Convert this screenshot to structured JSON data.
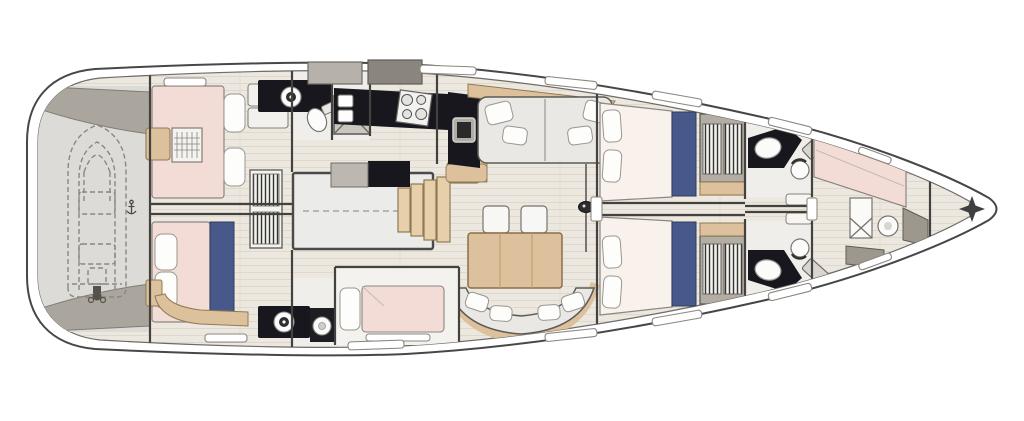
{
  "title": "Sailing yacht interior deck plan — top-down layout drawing, bow to the right",
  "canvas": {
    "width": 1024,
    "height": 421
  },
  "palette": {
    "outline": "#45423f",
    "floor_wood": "#ece8e0",
    "plank_line": "#d9d3c7",
    "deck_gray": "#aba69d",
    "garage_gray": "#dcdbd7",
    "bed_pink": "#f3dcd6",
    "pillow_white": "#fdfdfc",
    "accent_blue": "#47598b",
    "counter_dark": "#17171d",
    "furniture_gray": "#e9e8e4",
    "wood_tan": "#dcc19c",
    "steps_tan": "#e7d0a9",
    "wardrobe_gray": "#b3ada4",
    "white": "#ffffff"
  },
  "features": {
    "hull": {
      "label": "Hull outline"
    },
    "deck": {
      "label": "Side deck"
    },
    "cockpit": {
      "label": "Cockpit hatch boxes"
    },
    "garage": {
      "label": "Transom tender garage"
    },
    "dinghy": {
      "label": "Stowed dinghy (dashed outline)"
    },
    "motor": {
      "label": "Outboard motor"
    },
    "stern_marker": {
      "label": "Transom centerline cleat"
    },
    "aft_cabin_port": {
      "label": "Aft cabin (port) — double berth"
    },
    "aft_cabin_stbd": {
      "label": "Aft cabin (starboard) — double berth with blue runner"
    },
    "bookshelf": {
      "label": "Centerline bookshelf"
    },
    "aft_head_port": {
      "label": "Aft head (port) — sink and toilet"
    },
    "aft_head_stbd": {
      "label": "Aft head (starboard) — sink and toilet"
    },
    "shower": {
      "label": "Shower stall"
    },
    "engine": {
      "label": "Engine compartment under cockpit"
    },
    "steps": {
      "label": "Companionway steps"
    },
    "nav_seat": {
      "label": "Chart seat"
    },
    "galley": {
      "label": "Galley counters"
    },
    "stove": {
      "label": "Four-burner stove"
    },
    "galley_sink": {
      "label": "Galley double sink"
    },
    "fridge": {
      "label": "Fridge / appliance"
    },
    "sofa": {
      "label": "Salon sofa with cushions"
    },
    "chairs": {
      "label": "Dining chairs"
    },
    "table": {
      "label": "Dining table"
    },
    "settee": {
      "label": "Curved dining settee"
    },
    "mast": {
      "label": "Mast foot"
    },
    "berth_cabin": {
      "label": "Mid single-berth cabin"
    },
    "fwd_cabin_port": {
      "label": "Forward cabin (port)"
    },
    "fwd_cabin_stbd": {
      "label": "Forward cabin (starboard)"
    },
    "wardrobe": {
      "label": "Hanging wardrobe"
    },
    "fwd_head_port": {
      "label": "Forward head (port)"
    },
    "fwd_head_stbd": {
      "label": "Forward head (starboard)"
    },
    "crew_cabin": {
      "label": "Forepeak crew cabin with diagonal berth"
    },
    "crew_wc": {
      "label": "Crew toilet"
    },
    "bow_marker": {
      "label": "Bow star marker"
    },
    "window": {
      "label": "Hull window / deck hatch"
    }
  }
}
